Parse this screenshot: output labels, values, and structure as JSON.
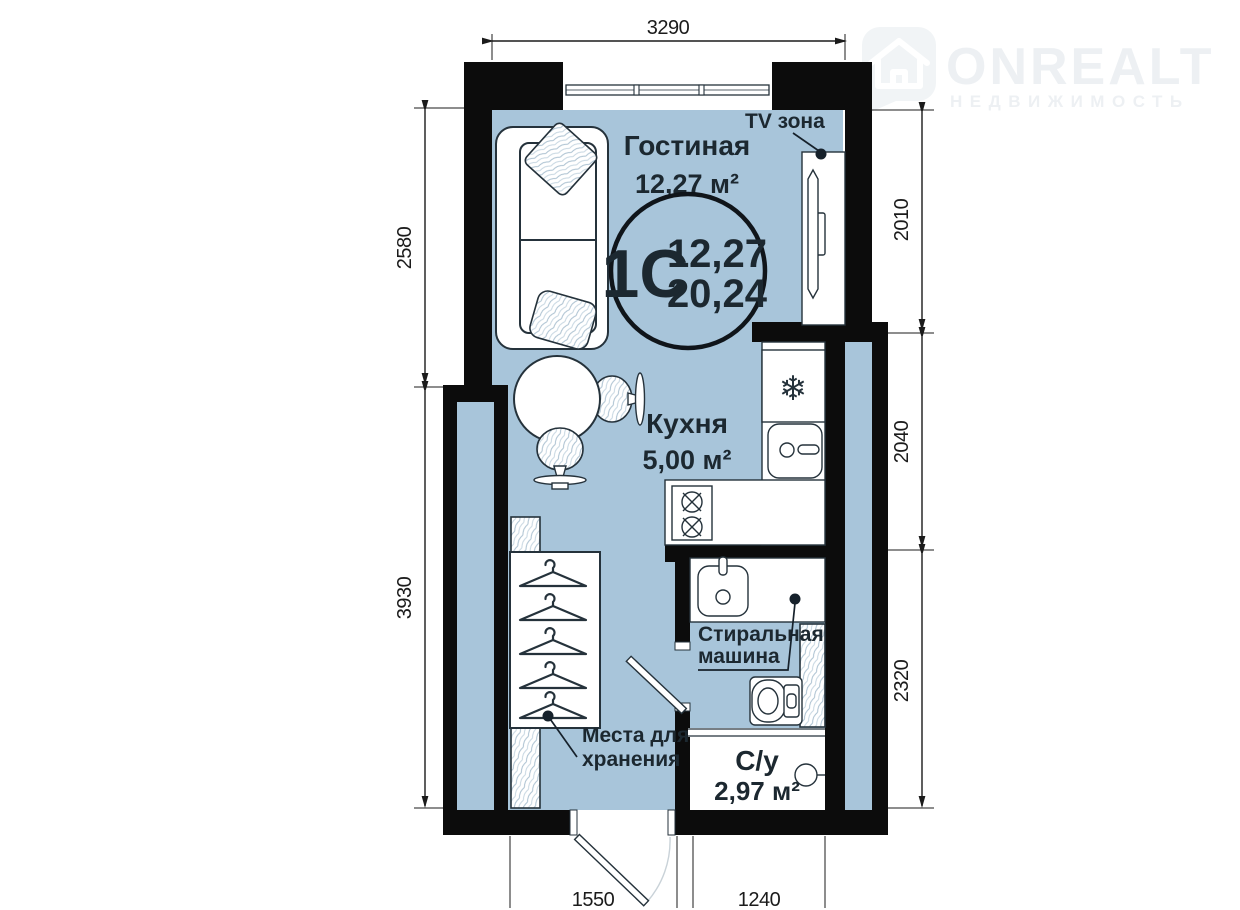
{
  "logo": {
    "brand": "ONREALT",
    "subtitle": "НЕДВИЖИМОСТЬ"
  },
  "badge": {
    "unit_type": "1С",
    "living_area": "12,27",
    "total_area": "20,24"
  },
  "rooms": {
    "living": {
      "name": "Гостиная",
      "area": "12,27 м²"
    },
    "kitchen": {
      "name": "Кухня",
      "area": "5,00 м²"
    },
    "bathroom": {
      "name": "С/у",
      "area": "2,97 м²"
    }
  },
  "annotations": {
    "tv_zone": "TV зона",
    "washing_machine": {
      "line1": "Стиральная",
      "line2": "машина"
    },
    "storage": {
      "line1": "Места для",
      "line2": "хранения"
    }
  },
  "icons": {
    "snowflake": "❄"
  },
  "dimensions_mm": {
    "top_width": "3290",
    "left_upper": "2580",
    "left_lower": "3930",
    "right_upper": "2010",
    "right_middle": "2040",
    "right_lower": "2320",
    "bottom_door": "1550",
    "bottom_bath": "1240"
  },
  "colors": {
    "floor": "#a8c5da",
    "wall": "#0c0c0c",
    "label": "#1c2830",
    "logo": "#edf0f3"
  }
}
